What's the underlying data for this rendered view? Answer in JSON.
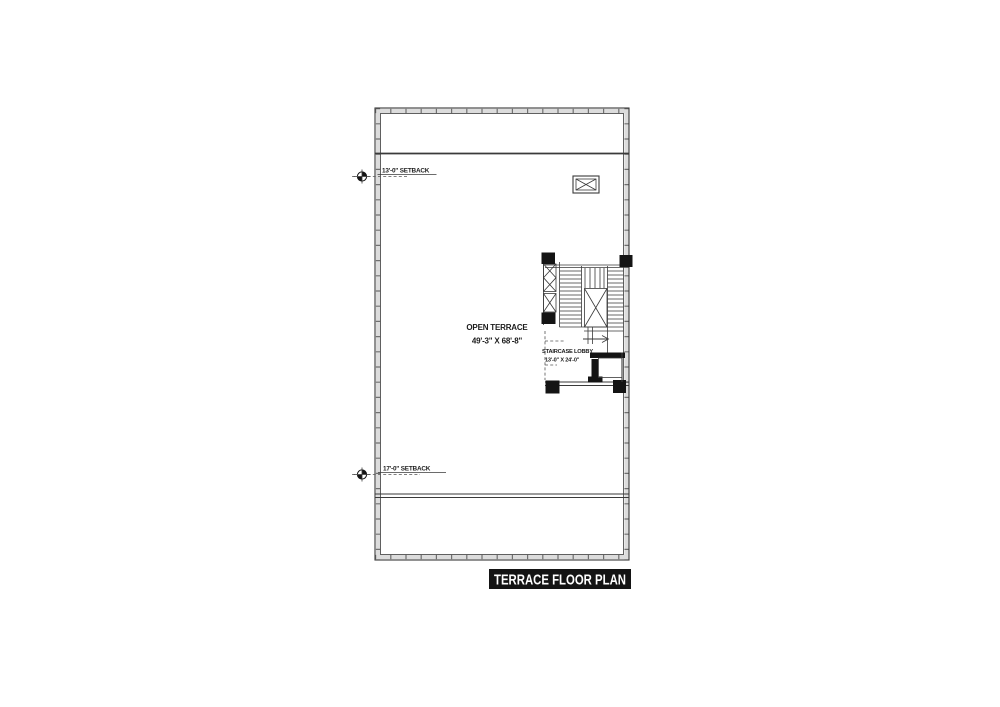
{
  "plan": {
    "title": "TERRACE FLOOR PLAN",
    "open_terrace": {
      "name": "OPEN TERRACE",
      "dimensions": "49'-3\" X 68'-8\""
    },
    "staircase_lobby": {
      "name": "STAIRCASE LOBBY",
      "dimensions": "13'-0\" X 24'-0\""
    },
    "setbacks": {
      "top": "13'-0\" SETBACK",
      "bottom": "17'-0\" SETBACK"
    }
  },
  "colors": {
    "ink": "#3a3a3a",
    "solid_black": "#141414",
    "wall_band": "#dcdcdc",
    "background": "#ffffff",
    "title_bg": "#141414",
    "title_fg": "#ffffff"
  }
}
